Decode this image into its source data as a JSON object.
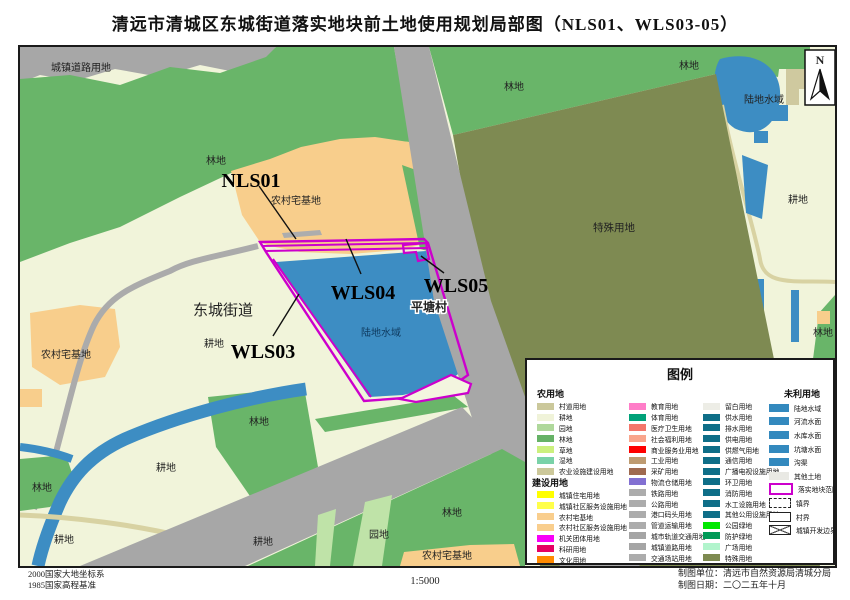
{
  "title": "清远市清城区东城街道落实地块前土地使用规划局部图（NLS01、WLS03-05）",
  "compass": {
    "label": "N"
  },
  "colors": {
    "parcel_outline": "#CC00CC",
    "water": "#3D8DC3",
    "forest": "#69B569",
    "road": "#A7A7A7",
    "cropland": "#F1F4DA",
    "homestead": "#F8CE8C",
    "special": "#7E8A52",
    "orchard": "#BFE3A8"
  },
  "map": {
    "labels": [
      "城镇道路用地",
      "林地",
      "农村宅基地",
      "林地",
      "林地",
      "陆地水域",
      "耕地",
      "特殊用地",
      "平塘村",
      "东城街道",
      "陆地水域",
      "耕地",
      "农村宅基地",
      "林地",
      "耕地",
      "林地",
      "耕地",
      "耕地",
      "林地",
      "园地",
      "农村宅基地",
      "林地"
    ],
    "parcels": {
      "nls01": "NLS01",
      "wls03": "WLS03",
      "wls04": "WLS04",
      "wls05": "WLS05"
    }
  },
  "legend": {
    "title": "图例",
    "col1": {
      "header1": "农用地",
      "items1": [
        {
          "label": "村道用地",
          "color": "#CBC89B"
        },
        {
          "label": "耕地",
          "color": "#F0F3D9"
        },
        {
          "label": "园地",
          "color": "#AFD89B"
        },
        {
          "label": "林地",
          "color": "#66B266"
        },
        {
          "label": "草地",
          "color": "#CCF07E"
        },
        {
          "label": "湿地",
          "color": "#7AD2A8"
        },
        {
          "label": "农业设施建设用地",
          "color": "#CCC89A"
        }
      ],
      "header2": "建设用地",
      "items2": [
        {
          "label": "城镇住宅用地",
          "color": "#FFFF00"
        },
        {
          "label": "城镇社区服务设施用地",
          "color": "#FFFF4A"
        },
        {
          "label": "农村宅基地",
          "color": "#F9CE8D"
        },
        {
          "label": "农村社区服务设施用地",
          "color": "#F9CE8D"
        },
        {
          "label": "机关团体用地",
          "color": "#F800F8"
        },
        {
          "label": "科研用地",
          "color": "#E60064"
        },
        {
          "label": "文化用地",
          "color": "#FF8A00"
        }
      ]
    },
    "col2": {
      "items": [
        {
          "label": "教育用地",
          "color": "#FF7DC8"
        },
        {
          "label": "体育用地",
          "color": "#00A279"
        },
        {
          "label": "医疗卫生用地",
          "color": "#F4766B"
        },
        {
          "label": "社会福利用地",
          "color": "#F9A58C"
        },
        {
          "label": "商业服务业用地",
          "color": "#FE0000"
        },
        {
          "label": "工业用地",
          "color": "#BE9B71"
        },
        {
          "label": "采矿用地",
          "color": "#9F6A50"
        },
        {
          "label": "物流仓储用地",
          "color": "#8270D2"
        },
        {
          "label": "铁路用地",
          "color": "#ACACAC"
        },
        {
          "label": "公路用地",
          "color": "#ACACAC"
        },
        {
          "label": "港口码头用地",
          "color": "#ACACAC"
        },
        {
          "label": "管道运输用地",
          "color": "#ACACAC"
        },
        {
          "label": "城市轨道交通用地",
          "color": "#A5A5A5"
        },
        {
          "label": "城镇道路用地",
          "color": "#A5A5A5"
        },
        {
          "label": "交通场站用地",
          "color": "#ACACAC"
        }
      ]
    },
    "col3": {
      "items": [
        {
          "label": "留白用地",
          "color": "#EDEDE6"
        },
        {
          "label": "供水用地",
          "color": "#0E6E88"
        },
        {
          "label": "排水用地",
          "color": "#0E6E88"
        },
        {
          "label": "供电用地",
          "color": "#0E6E88"
        },
        {
          "label": "供燃气用地",
          "color": "#0E6E88"
        },
        {
          "label": "通信用地",
          "color": "#0E6E88"
        },
        {
          "label": "广播电视设施用地",
          "color": "#0E6E88"
        },
        {
          "label": "环卫用地",
          "color": "#0E6E88"
        },
        {
          "label": "消防用地",
          "color": "#0E6E88"
        },
        {
          "label": "水工设施用地",
          "color": "#0E6E88"
        },
        {
          "label": "其他公用设施用地",
          "color": "#0E6E88"
        },
        {
          "label": "公园绿地",
          "color": "#00E800"
        },
        {
          "label": "防护绿地",
          "color": "#009A57"
        },
        {
          "label": "广场用地",
          "color": "#B1F4CC"
        },
        {
          "label": "特殊用地",
          "color": "#7E8A50"
        }
      ]
    },
    "col4": {
      "header": "未利用地",
      "items": [
        {
          "label": "陆地水域",
          "color": "#3389BE"
        },
        {
          "label": "河流水面",
          "color": "#3389BE"
        },
        {
          "label": "水库水面",
          "color": "#3389BE"
        },
        {
          "label": "坑塘水面",
          "color": "#3389BE"
        },
        {
          "label": "沟渠",
          "color": "#3389BE"
        },
        {
          "label": "其他土地",
          "color": "#E9E9E4"
        },
        {
          "label": "落实地块范围",
          "type": "outline-purple"
        },
        {
          "label": "镇界",
          "type": "dashed"
        },
        {
          "label": "村界",
          "type": "solid"
        },
        {
          "label": "城镇开发边界",
          "type": "cross"
        }
      ]
    }
  },
  "footer": {
    "datum_line1": "2000国家大地坐标系",
    "datum_line2": "1985国家高程基准",
    "scale": "1:5000",
    "agency": "制图单位：清远市自然资源局清城分局",
    "date": "制图日期：二〇二五年十月"
  }
}
